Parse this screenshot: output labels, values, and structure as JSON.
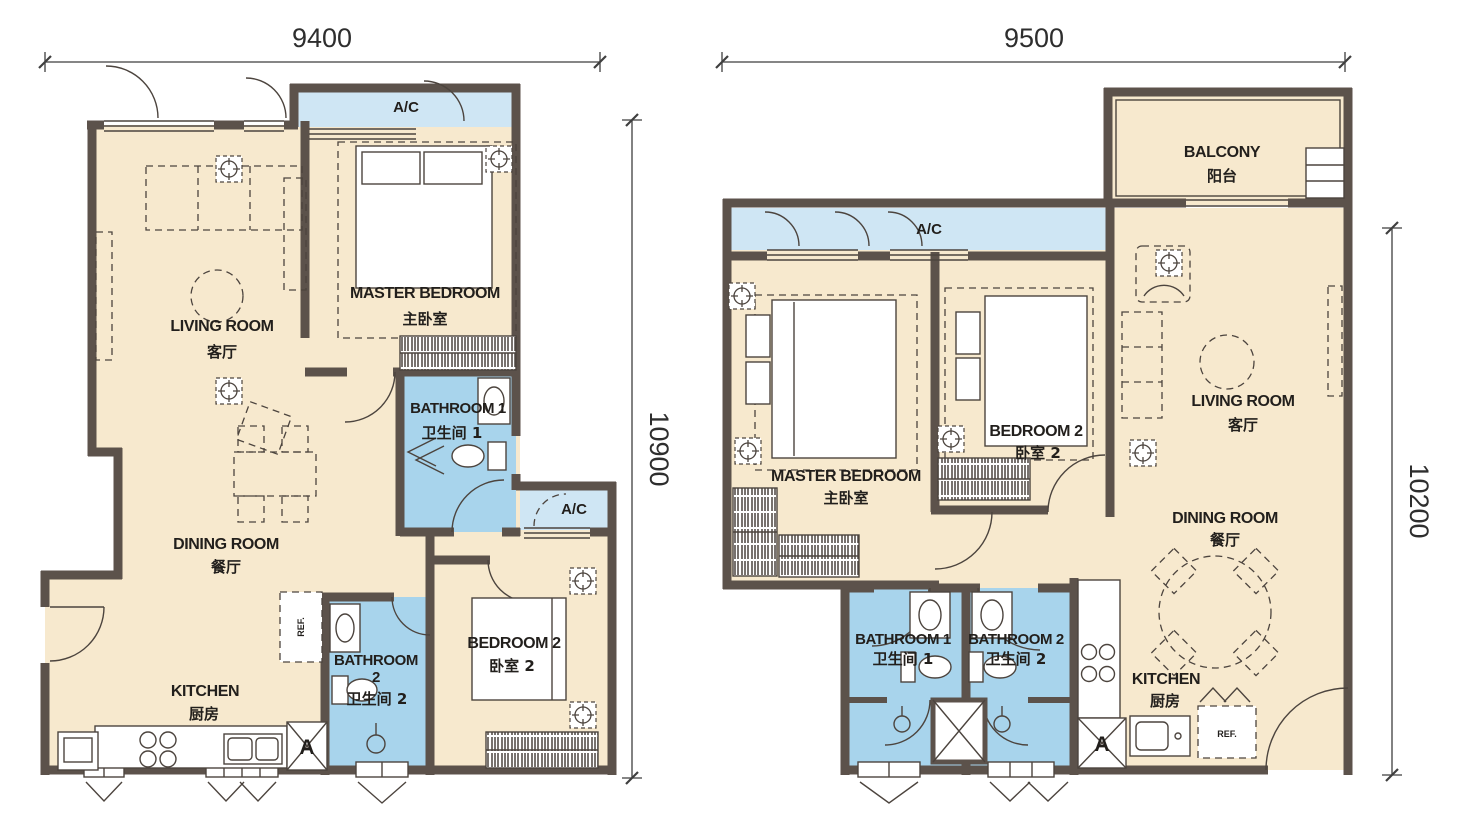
{
  "colors": {
    "wall": "#5c524b",
    "floor": "#f7e9ce",
    "bath": "#a8d4ec",
    "ac": "#cfe6f4",
    "line": "#4c443e",
    "dim": "#3f3f3f"
  },
  "left_plan": {
    "dim_width": "9400",
    "dim_height": "10900",
    "ac_top_label": "A/C",
    "ac_side_label": "A/C",
    "living_en": "LIVING ROOM",
    "living_zh": "客厅",
    "master_en": "MASTER BEDROOM",
    "master_zh": "主卧室",
    "bath1_en": "BATHROOM 1",
    "bath1_zh": "卫生间 1",
    "dining_en": "DINING ROOM",
    "dining_zh": "餐厅",
    "bed2_en": "BEDROOM 2",
    "bed2_zh": "卧室 2",
    "bath2_line1": "BATHROOM",
    "bath2_line2": "2",
    "bath2_zh": "卫生间 2",
    "kitchen_en": "KITCHEN",
    "kitchen_zh": "厨房",
    "fridge_label": "REF.",
    "appliance_label": "A"
  },
  "right_plan": {
    "dim_width": "9500",
    "dim_height": "10200",
    "balcony_en": "BALCONY",
    "balcony_zh": "阳台",
    "ac_label": "A/C",
    "master_en": "MASTER BEDROOM",
    "master_zh": "主卧室",
    "bed2_en": "BEDROOM 2",
    "bed2_zh": "卧室 2",
    "living_en": "LIVING ROOM",
    "living_zh": "客厅",
    "dining_en": "DINING ROOM",
    "dining_zh": "餐厅",
    "bath1_en": "BATHROOM 1",
    "bath1_zh": "卫生间 1",
    "bath2_en": "BATHROOM 2",
    "bath2_zh": "卫生间 2",
    "kitchen_en": "KITCHEN",
    "kitchen_zh": "厨房",
    "fridge_label": "REF.",
    "appliance_label": "A"
  }
}
